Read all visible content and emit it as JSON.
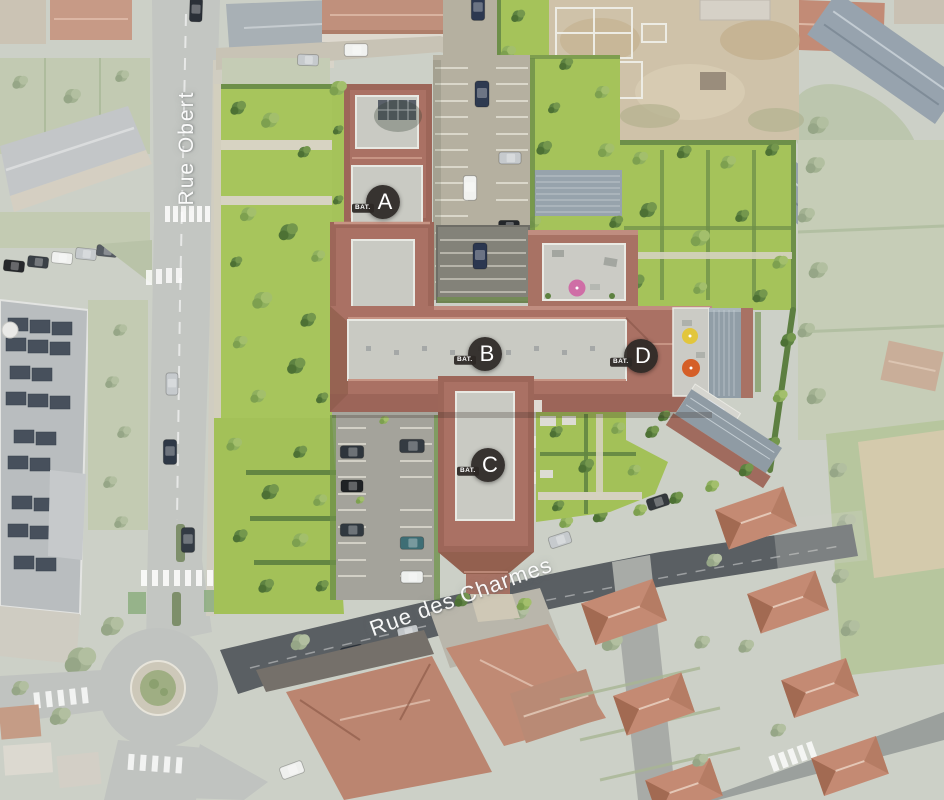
{
  "markers": {
    "prefix": "BAT.",
    "items": [
      {
        "letter": "A"
      },
      {
        "letter": "B"
      },
      {
        "letter": "C"
      },
      {
        "letter": "D"
      }
    ]
  },
  "streets": {
    "items": [
      {
        "name": "Rue Obert"
      },
      {
        "name": "Rue des Charmes"
      }
    ]
  },
  "colors": {
    "marker_background": "#2c2825",
    "marker_text": "#ffffff",
    "street_label_text": "#ffffff",
    "terracotta_roof": "#aa7164",
    "flat_roof_gray": "#c9cac3",
    "lawn_green": "#a7c55c",
    "slate_roof": "#919ea7",
    "parking_surface": "#b5b0a0",
    "road_gray": "#c3c6c2",
    "asphalt_dark": "#5a5f63",
    "umbrella_pink": "#cf6ea6",
    "umbrella_yellow": "#e2c63c",
    "umbrella_orange": "#d55f28",
    "pool_blue": "#3f6dc0"
  }
}
